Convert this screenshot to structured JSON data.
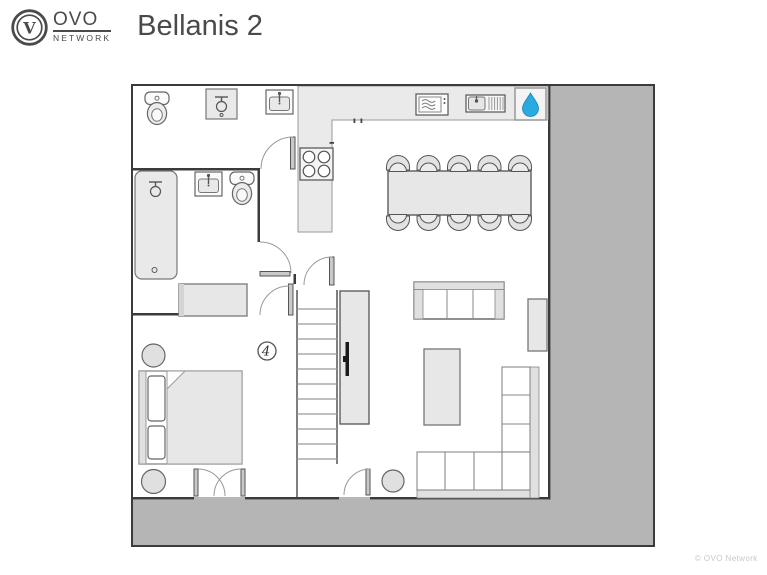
{
  "header": {
    "logo": {
      "monogram": "V",
      "brand": "OVO",
      "network": "NETWORK"
    },
    "title": "Bellanis 2"
  },
  "plan": {
    "floor_label": "4",
    "colors": {
      "accent": "#29abe2",
      "outside_gray": "#b5b5b5",
      "wall": "#3b3b3b",
      "fixture_fill": "#e8e8e8"
    },
    "fixtures": [
      "toilet",
      "shower",
      "washbasin",
      "bathtub",
      "washbasin",
      "toilet",
      "stove",
      "microwave",
      "kitchen-sink",
      "hot-water-drop",
      "dining-table",
      "dining-chairs-x10",
      "sofa-3-seat",
      "sideboard",
      "coffee-table",
      "corner-sofa",
      "pouf",
      "dresser",
      "double-bed",
      "pouf",
      "pouf",
      "stairs",
      "tv-unit",
      "french-door",
      "door"
    ]
  },
  "footer": {
    "watermark": "© OVO Network"
  }
}
